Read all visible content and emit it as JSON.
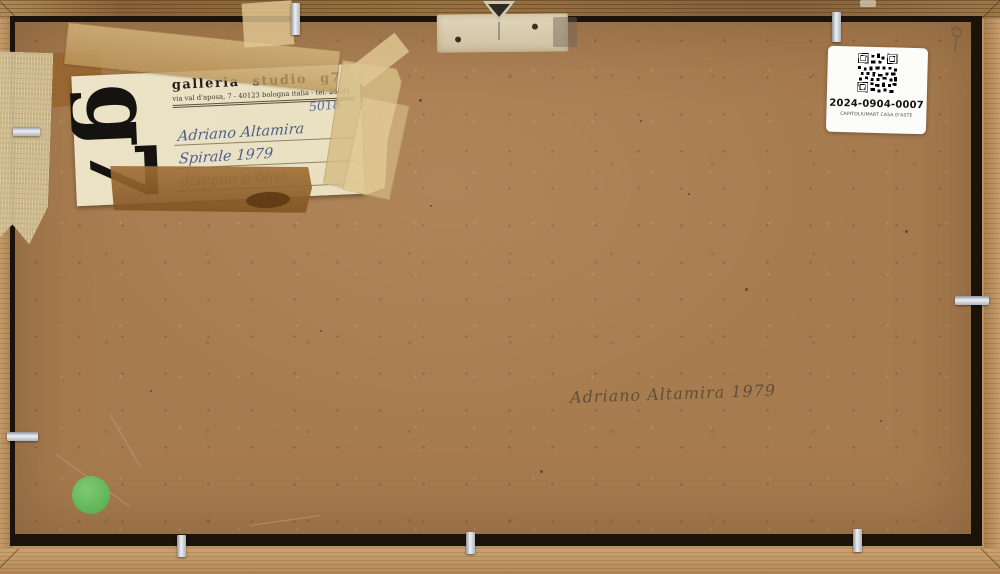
{
  "palette": {
    "board_brown": "#a67b4f",
    "frame_wood": "#c39a66",
    "gap_shadow": "#140d06",
    "label_cream": "#ece3c8",
    "tape_amber": "#caa468",
    "tape_brown": "#8f6130",
    "ink_blue": "#4e5f86",
    "print_black": "#241f18",
    "pencil_gray": "#6b5844",
    "green_dot": "#6cbd62",
    "sticker_white": "#fcfcfa",
    "clip_silver": "#d7dade"
  },
  "gallery_label": {
    "logo_text": "g7",
    "title": "galleria studio g7",
    "address": "via val d'aposa, 7 - 40123 bologna italia - tel. 26641",
    "inventory_number": "5018",
    "artist": "Adriano Altamira",
    "work_title_year": "Spirale 1979",
    "medium": "disegno a biro"
  },
  "auction_sticker": {
    "icon": "qr-code",
    "code": "2024-0904-0007",
    "house": "CAPITOLIUMART CASA D'ASTE"
  },
  "inscription": {
    "signature": "Adriano Altamira 1979"
  },
  "hardware": {
    "hanger_icon": "triangle-hanger",
    "clip_icon": "metal-clip"
  }
}
